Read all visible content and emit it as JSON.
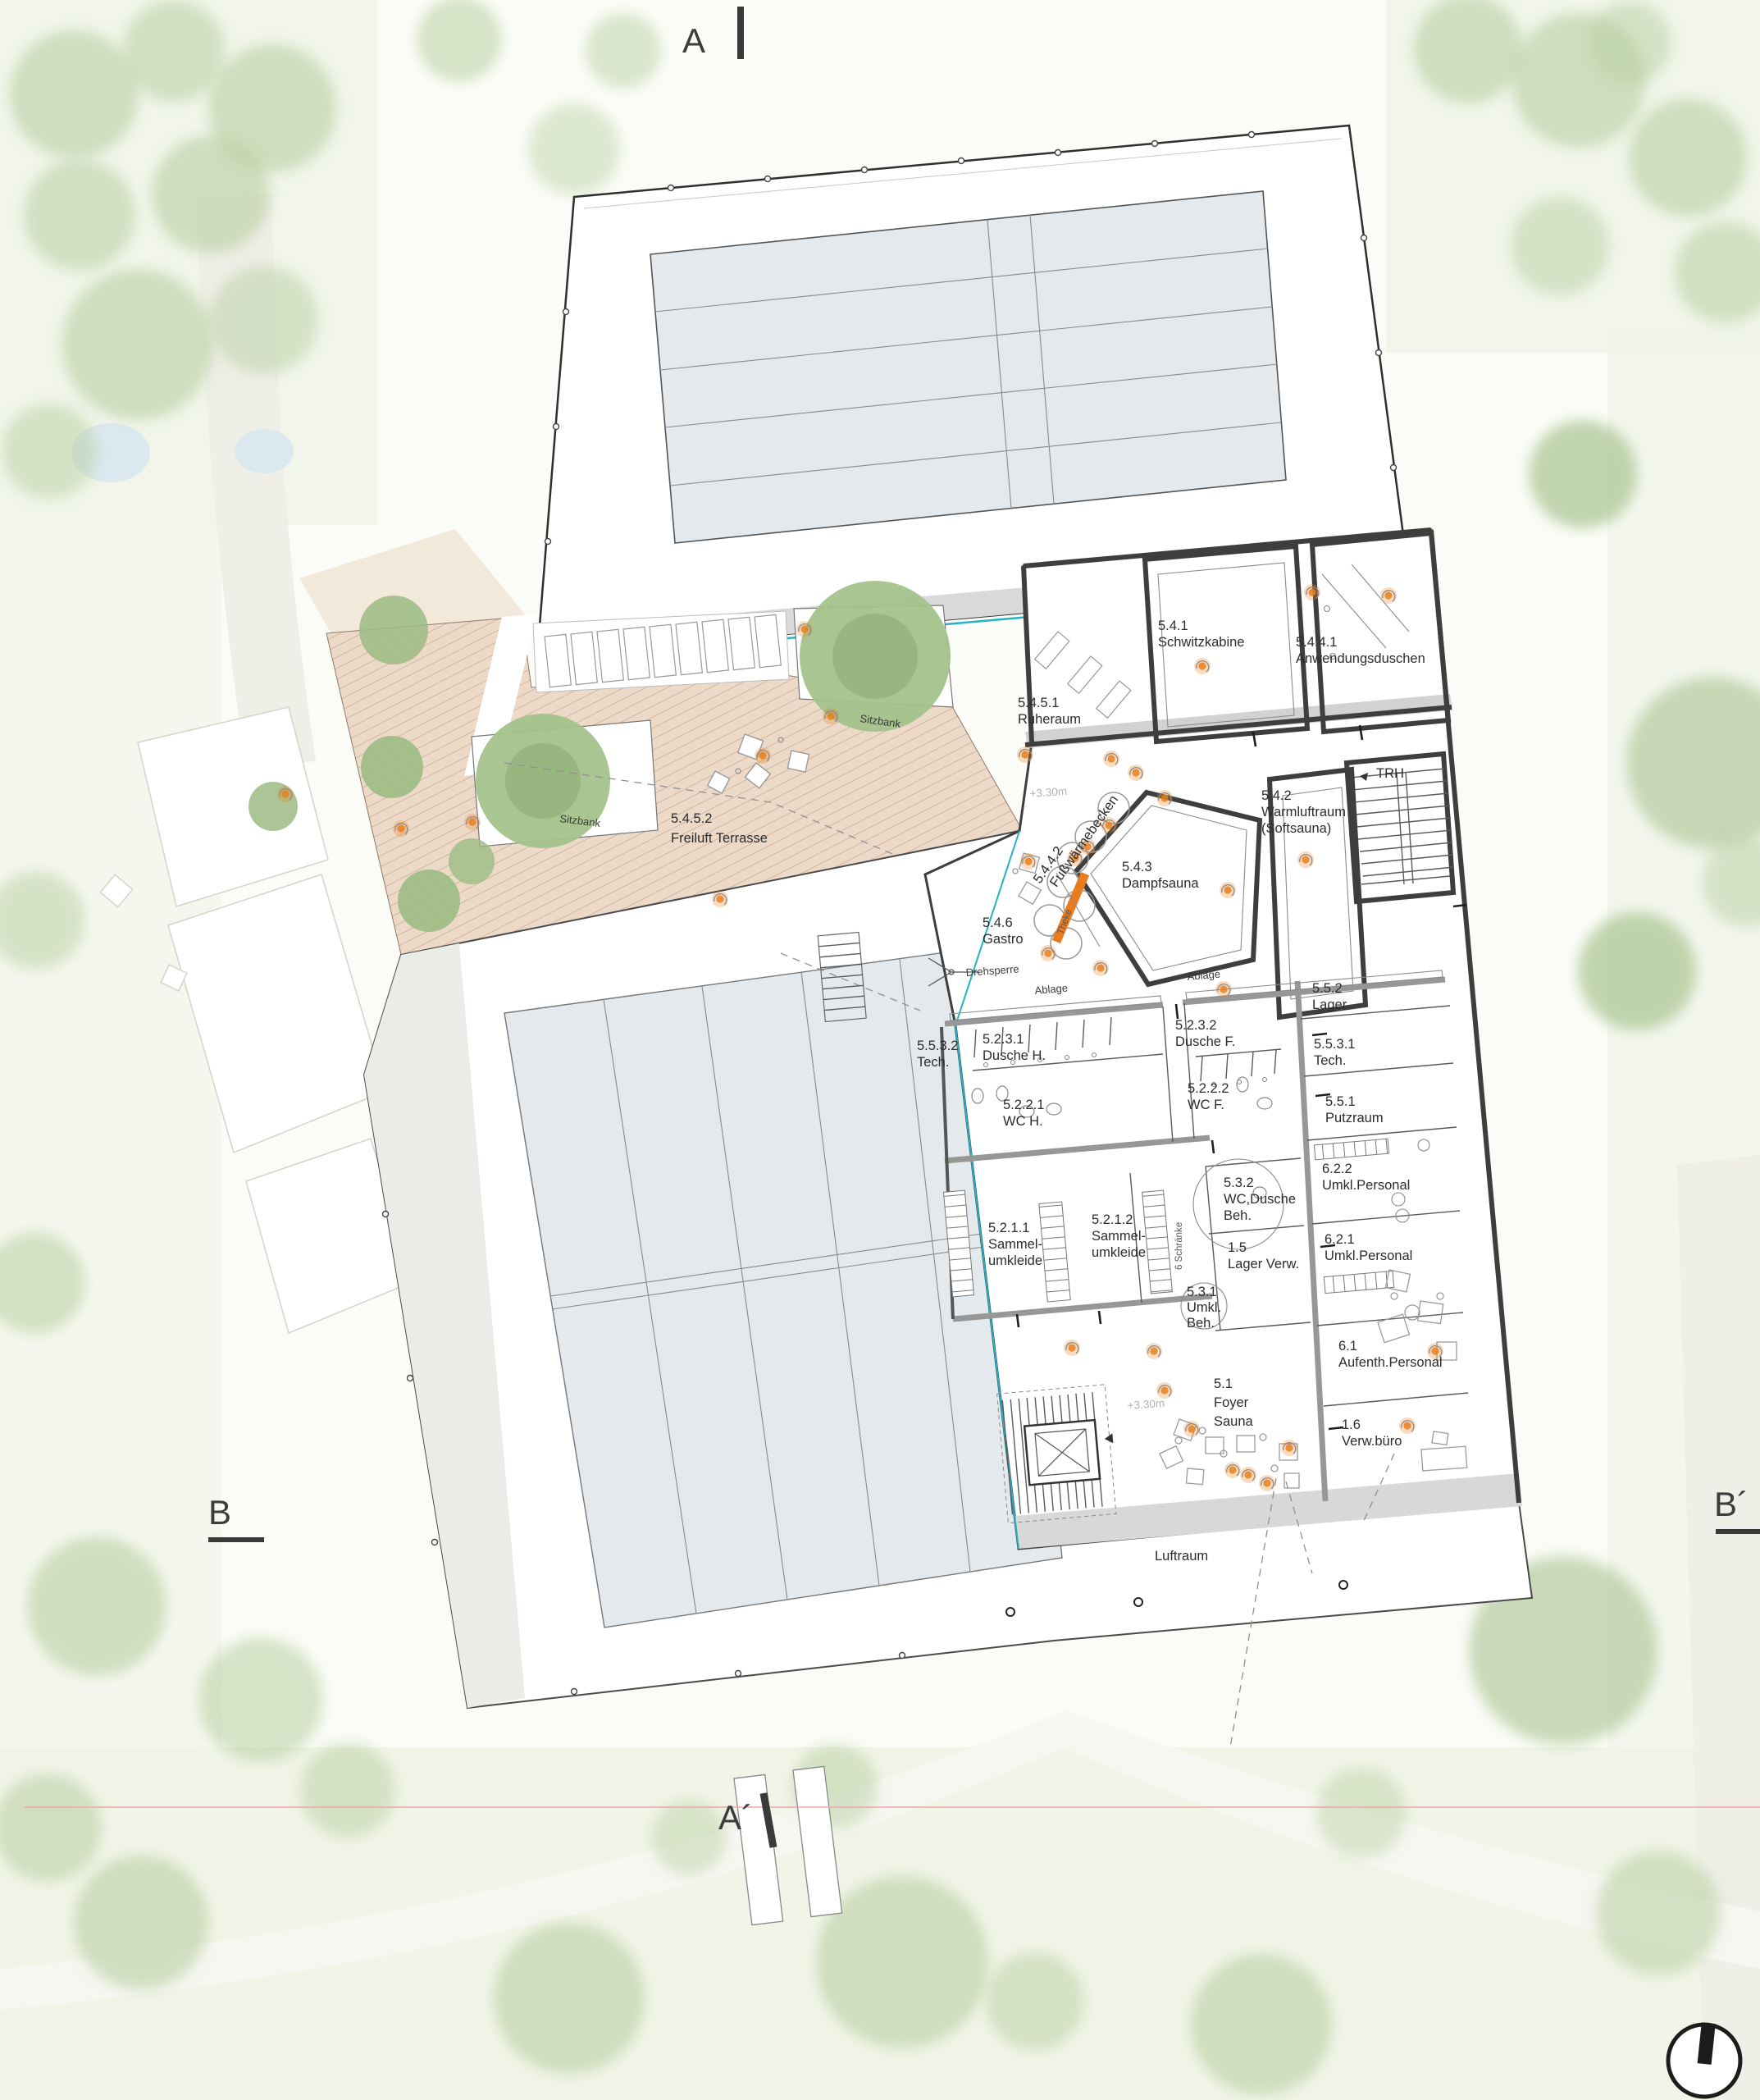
{
  "plan_type": "architectural floor plan, sauna level with swimming pools",
  "rooms": {
    "ruheraum": [
      "5.4.5.1",
      "Ruheraum"
    ],
    "schwitzkabine": [
      "5.4.1",
      "Schwitzkabine"
    ],
    "anwendungsduschen": [
      "5.4.4.1",
      "Anwendungsduschen"
    ],
    "warmluftraum": [
      "5.4.2",
      "Warmluftraum",
      "(Softsauna)"
    ],
    "trh": [
      "TRH"
    ],
    "freiluft": [
      "5.4.5.2",
      "Freiluft Terrasse"
    ],
    "fussbecken": [
      "5.4.4.2",
      "Fußwärmebecken"
    ],
    "dampfsauna": [
      "5.4.3",
      "Dampfsauna"
    ],
    "gastro": [
      "5.4.6",
      "Gastro"
    ],
    "lager552": [
      "5.5.2",
      "Lager"
    ],
    "tech5532": [
      "5.5.3.2",
      "Tech."
    ],
    "dusche_h": [
      "5.2.3.1",
      "Dusche H."
    ],
    "dusche_f": [
      "5.2.3.2",
      "Dusche F."
    ],
    "tech5531": [
      "5.5.3.1",
      "Tech."
    ],
    "wc_h": [
      "5.2.2.1",
      "WC H."
    ],
    "wc_f": [
      "5.2.2.2",
      "WC F."
    ],
    "putzraum": [
      "5.5.1",
      "Putzraum"
    ],
    "umkl622": [
      "6.2.2",
      "Umkl.Personal"
    ],
    "wcduschebeh": [
      "5.3.2",
      "WC,Dusche",
      "Beh."
    ],
    "umkl621": [
      "6.2.1",
      "Umkl.Personal"
    ],
    "sammel1": [
      "5.2.1.1",
      "Sammel-",
      "umkleide"
    ],
    "sammel2": [
      "5.2.1.2",
      "Sammel-",
      "umkleide"
    ],
    "lagerverw": [
      "1.5",
      "Lager Verw."
    ],
    "umklbeh": [
      "5.3.1",
      "Umkl.",
      "Beh."
    ],
    "aufenth": [
      "6.1",
      "Aufenth.Personal"
    ],
    "foyer": [
      "5.1",
      "Foyer",
      "Sauna"
    ],
    "verwbuero": [
      "1.6",
      "Verw.büro"
    ]
  },
  "ann": {
    "sitzbank": "Sitzbank",
    "ablage": "Ablage",
    "theke": "Theke",
    "drehsperre": "Drehsperre",
    "schraenke": "6 Schränke",
    "luftraum": "Luftraum",
    "level": "+3.30m"
  },
  "sec": {
    "a": "A",
    "a_prime": "A´",
    "b": "B",
    "b_prime": "B´"
  },
  "colors": {
    "accent_orange": "#e87c1e",
    "pool_water": "#e3e9ed",
    "terrace_fill": "#edd9c8",
    "line_cyan": "#25b2c6",
    "wall_dark": "#3e3e3e",
    "wall_gray": "#979797",
    "section_line_red": "#eaa7a7",
    "tree_green": "#b7cfa0"
  }
}
